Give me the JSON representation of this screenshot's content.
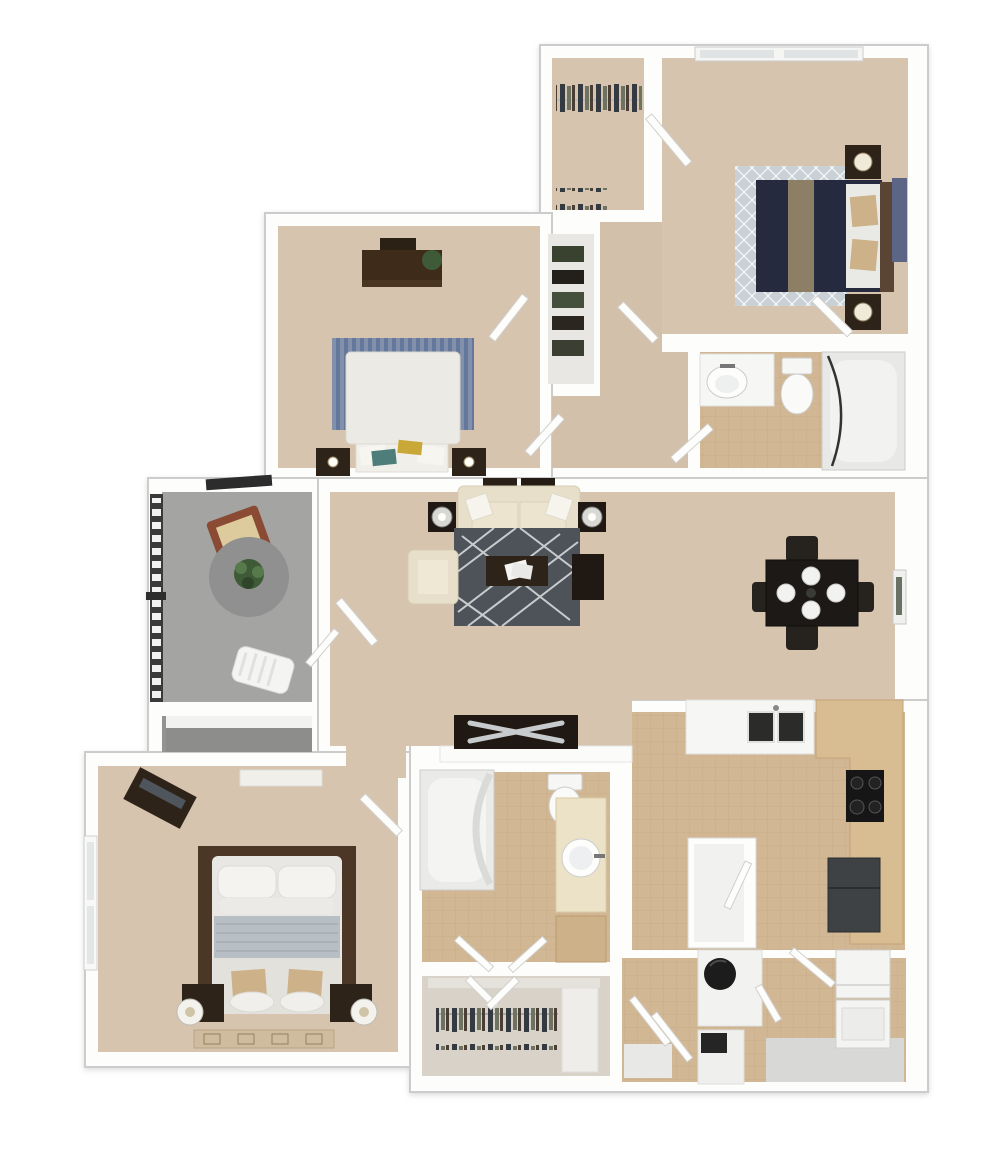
{
  "image_type": "3d-rendered-apartment-floor-plan",
  "palette": {
    "page_bg": "#ffffff",
    "wall": "#fdfdfc",
    "wall_edge": "#cccccc",
    "carpet": "#d7c4af",
    "carpet_hall": "#d3c0ab",
    "tile": "#d2b795",
    "tile_line": "#b89a74",
    "patio": "#a4a4a2",
    "patio_dark": "#939390",
    "closet_floor": "#e9e7e3",
    "closet2_floor": "#d8d2c8",
    "wood_dark": "#2e2318",
    "wood_mid": "#3e2b1a",
    "espresso": "#201812",
    "navy_bed": "#252a3e",
    "tan_runner": "#8d7f66",
    "tan_pillow": "#cdb188",
    "cream_sofa": "#e7dfc9",
    "cream_seat": "#efe8d4",
    "white_fixture": "#f6f6f4",
    "rug_slate": "#4d5358",
    "rug_diamond": "#c9d1d7",
    "rug_blue": "#72839f",
    "rug_brown": "#4c3626",
    "blanket_gray": "#b7bec4",
    "counter_tan": "#d9bd92",
    "fridge_gray": "#3f4245",
    "stove_black": "#161616",
    "plant_green": "#3f5a36",
    "teal_pillow": "#4f7d7a",
    "yellow_pillow": "#c9a838",
    "terracotta_chair": "#8a4a33",
    "chair_cushion": "#decb9d",
    "railing_dark": "#3a3a3a",
    "heater_black": "#1c1c1c",
    "door_leaf": "#fdfdfc",
    "mat_gray": "#d8d8d6",
    "door_inset": "#6a7265",
    "lamp_cream": "#f0ead8",
    "art_blue": "#5c6586",
    "bed_white": "#e8e7e3"
  },
  "rooms": [
    {
      "id": "walk_in_closet_top",
      "name": "walk-in closet",
      "floor": "carpet",
      "furniture": [
        "hanging clothes row (top)",
        "hanging clothes row (bottom)",
        "door to bedroom"
      ]
    },
    {
      "id": "bedroom_top_right",
      "name": "bedroom 2",
      "floor": "carpet",
      "furniture": [
        "queen bed with navy duvet and tan runner",
        "two dark nightstands with lamps",
        "diamond-pattern area rug",
        "window on top wall",
        "blue wall hanging",
        "white pillows",
        "tan accent pillows"
      ]
    },
    {
      "id": "hallway_top",
      "name": "hallway with linen closet",
      "floor": "carpet",
      "furniture": [
        "linen closet shelves",
        "swing doors"
      ]
    },
    {
      "id": "bedroom_top_left",
      "name": "bedroom 3",
      "floor": "carpet",
      "furniture": [
        "writing desk with chair and plant",
        "bed with white duvet",
        "blue striped rug",
        "bench with teal and yellow pillows",
        "two dark nightstands with lamps"
      ]
    },
    {
      "id": "bathroom_right",
      "name": "hall bathroom",
      "floor": "tile",
      "furniture": [
        "vanity with oval sink",
        "toilet",
        "bathtub with shower curtain rod"
      ]
    },
    {
      "id": "living_room",
      "name": "living room",
      "floor": "carpet",
      "furniture": [
        "cream three-seat sofa with throw pillows",
        "two dark end tables with lamps",
        "sofa-table decor",
        "cream armchair",
        "dark side table",
        "dark coffee table with book",
        "slate geometric rug",
        "media console with X pattern on half wall"
      ]
    },
    {
      "id": "dining_area",
      "name": "dining area",
      "floor": "carpet",
      "furniture": [
        "square dark dining table",
        "four dark chairs",
        "four white place settings",
        "entry door on right wall"
      ]
    },
    {
      "id": "balcony_patio",
      "name": "balcony / patio",
      "floor": "concrete",
      "furniture": [
        "metal railing",
        "terracotta bistro chair with cushion",
        "round gray rug with potted plant",
        "white lounge chair",
        "storage closet with shelf"
      ]
    },
    {
      "id": "kitchen",
      "name": "kitchen",
      "floor": "tile",
      "furniture": [
        "white counter with double sink",
        "L-shaped tan counter",
        "four-burner stove",
        "refrigerator",
        "pantry closet"
      ]
    },
    {
      "id": "master_bedroom",
      "name": "master bedroom",
      "floor": "carpet",
      "furniture": [
        "king bed with gray blanket and white pillows",
        "brown area rug behind bed",
        "two nightstands with round white lamps",
        "diagonal media stand",
        "wardrobe shelf",
        "window on left wall",
        "patterned foot rug",
        "tan accent pillows"
      ]
    },
    {
      "id": "master_bathroom",
      "name": "master bathroom",
      "floor": "tile",
      "furniture": [
        "bathtub with curved curtain",
        "toilet",
        "cream vanity with round sink",
        "tan linen cabinet",
        "double swing doors"
      ]
    },
    {
      "id": "master_closet",
      "name": "master walk-in closet",
      "floor": "carpet",
      "furniture": [
        "hanging clothes",
        "side shelving",
        "double doors"
      ]
    },
    {
      "id": "utility_hall",
      "name": "utility hallway",
      "floor": "tile",
      "furniture": [
        "water-heater closet",
        "small storage closet",
        "bifold doors",
        "floor mat"
      ]
    },
    {
      "id": "laundry_closet",
      "name": "laundry closet",
      "floor": "tile",
      "furniture": [
        "stacked washer and dryer",
        "swing door"
      ]
    }
  ]
}
